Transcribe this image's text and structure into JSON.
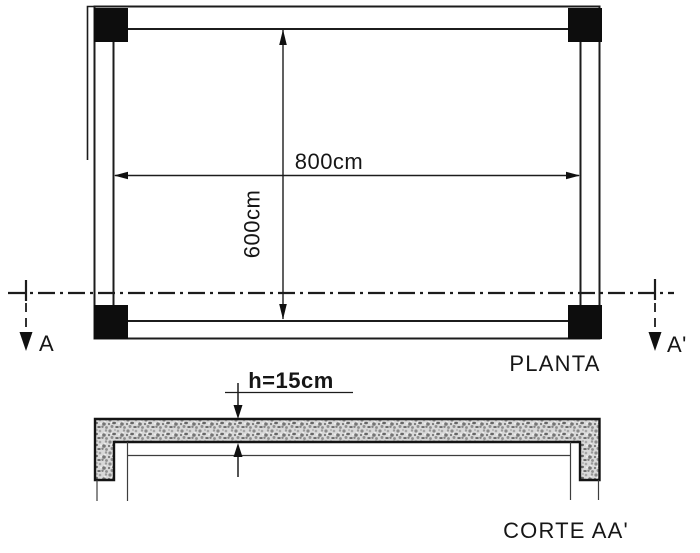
{
  "drawing": {
    "background": "#ffffff",
    "line_color": "#1c1c1c",
    "column_fill": "#0d0d0d",
    "plan": {
      "label": "PLANTA",
      "width_dim_label": "800cm",
      "height_dim_label": "600cm",
      "width_cm": 800,
      "height_cm": 600
    },
    "section": {
      "label": "CORTE AA'",
      "thickness_dim_label": "h=15cm",
      "thickness_cm": 15
    },
    "cut_line": {
      "start_label": "A",
      "end_label": "A'"
    }
  }
}
